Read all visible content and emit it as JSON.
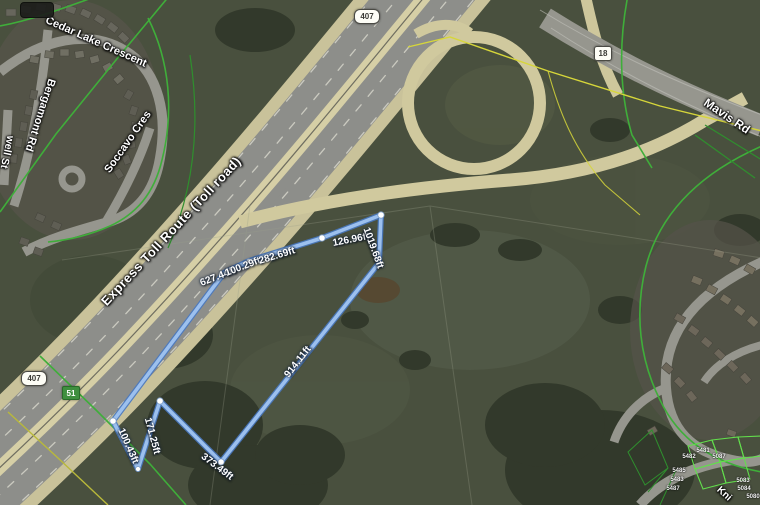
{
  "map": {
    "type": "satellite-parcel-view",
    "colors": {
      "field": "#49503e",
      "trees": "#31382a",
      "highway_shoulder": "#c9c29a",
      "highway_lanes": "#8d8e8a",
      "highway_median": "#d6cfa6",
      "minor_road": "#96968e",
      "parcel_green": "#3fae3a",
      "parcel_lime": "#62df4c",
      "parcel_yellow": "#d6d63a",
      "measure_line_fill": "#9cc0ee",
      "measure_line_edge": "#4878c0"
    },
    "shields": {
      "hwy407_top": "407",
      "hwy407_bottom": "407",
      "exit18": "18",
      "marker51": "51"
    },
    "streets": {
      "cedar_lake": "Cedar Lake Crescent",
      "bergamont": "Bergamont Rd",
      "soccavo": "Soccavo Cres",
      "well": "well St",
      "express_toll": "Express Toll Route (Toll road)",
      "mavis": "Mavis Rd",
      "knights_partial": "Kni"
    },
    "measurements": [
      {
        "label": "627.44ft"
      },
      {
        "label": "100.29ft"
      },
      {
        "label": "282.69ft"
      },
      {
        "label": "126.96ft"
      },
      {
        "label": "1019.68ft"
      },
      {
        "label": "914.11ft"
      },
      {
        "label": "373.49ft"
      },
      {
        "label": "171.25ft"
      },
      {
        "label": "100.43ft"
      }
    ],
    "parcel_numbers": [
      "5481",
      "5482",
      "5087",
      "5485",
      "5483",
      "5487",
      "5083",
      "5084",
      "5080"
    ]
  }
}
